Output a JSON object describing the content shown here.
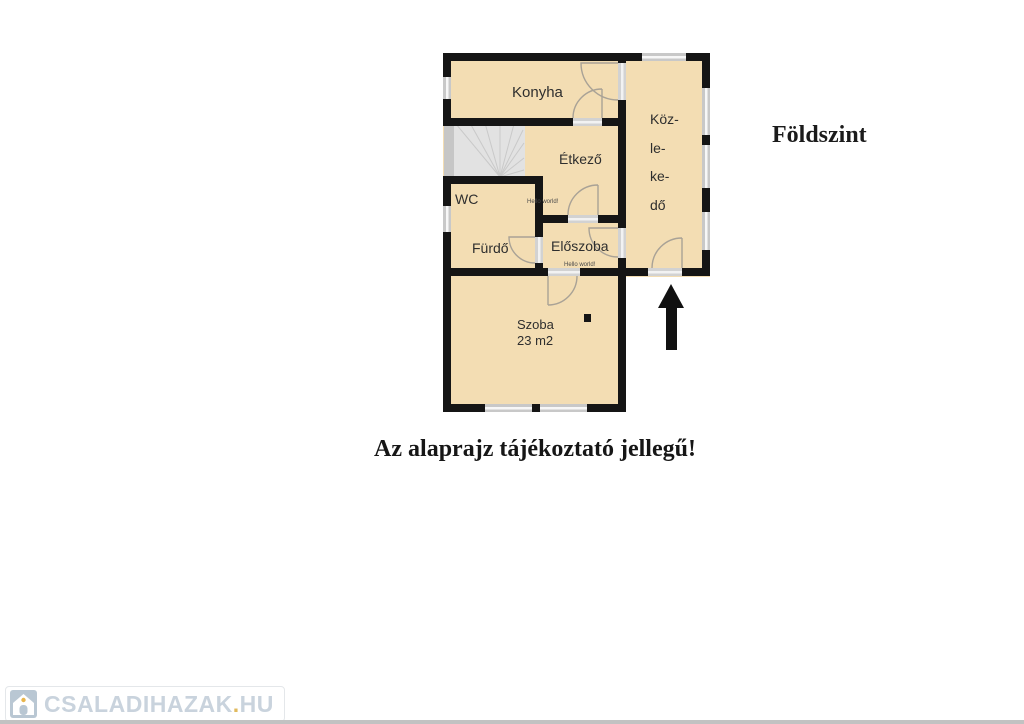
{
  "floor_plan": {
    "title": "Földszint",
    "caption": "Az alaprajz tájékoztató jellegű!",
    "rooms": {
      "konyha": "Konyha",
      "etkezo": "Étkező",
      "wc": "WC",
      "furdo": "Fürdő",
      "eloszoba": "Előszoba",
      "szoba_name": "Szoba",
      "szoba_area": "23 m2",
      "kozlekedo_lines": [
        "Köz-",
        "le-",
        "ke-",
        "dő"
      ]
    },
    "small_watermark": "Hello world!",
    "colors": {
      "room_fill": "#f3ddb3",
      "wall": "#151515",
      "window_gray": "#c8c8c8",
      "stairs_gray": "#e2e2e2",
      "accent_yellow": "#e8b54c",
      "brand_gray_blue": "#c9d3dd"
    }
  },
  "branding": {
    "site": "CSALADIHAZAK",
    "dot": ".",
    "tld": "HU"
  }
}
